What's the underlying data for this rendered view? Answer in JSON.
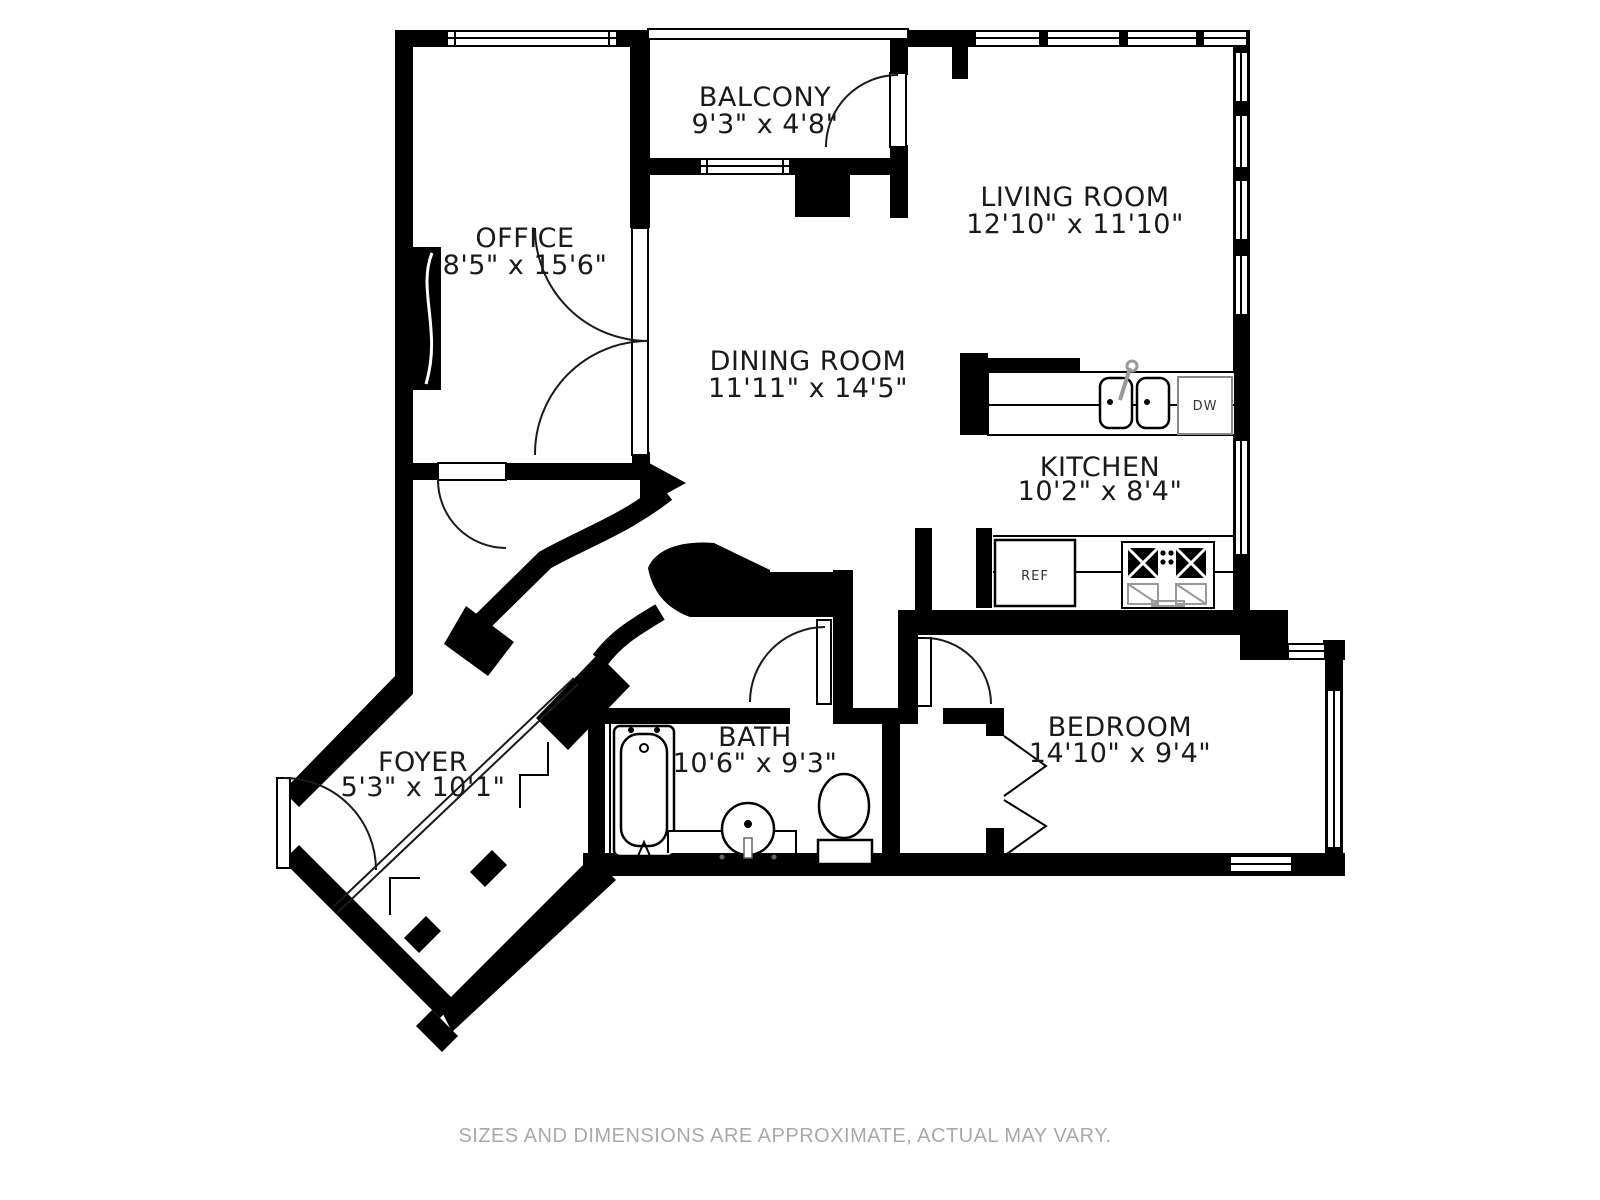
{
  "plan": {
    "wall_color": "#000000",
    "rooms": [
      {
        "id": "balcony",
        "name": "BALCONY",
        "dims": "9'3\" x 4'8\""
      },
      {
        "id": "living-room",
        "name": "LIVING ROOM",
        "dims": "12'10\" x 11'10\""
      },
      {
        "id": "office",
        "name": "OFFICE",
        "dims": "8'5\" x 15'6\""
      },
      {
        "id": "dining-room",
        "name": "DINING ROOM",
        "dims": "11'11\" x 14'5\""
      },
      {
        "id": "kitchen",
        "name": "KITCHEN",
        "dims": "10'2\" x 8'4\""
      },
      {
        "id": "foyer",
        "name": "FOYER",
        "dims": "5'3\" x 10'1\""
      },
      {
        "id": "bath",
        "name": "BATH",
        "dims": "10'6\" x 9'3\""
      },
      {
        "id": "bedroom",
        "name": "BEDROOM",
        "dims": "14'10\" x 9'4\""
      }
    ],
    "appliances": {
      "dishwasher_label": "DW",
      "refrigerator_label": "REF"
    },
    "footer": {
      "text": "SIZES AND DIMENSIONS ARE APPROXIMATE, ACTUAL MAY VARY.",
      "color": "#a9a9a9"
    }
  }
}
